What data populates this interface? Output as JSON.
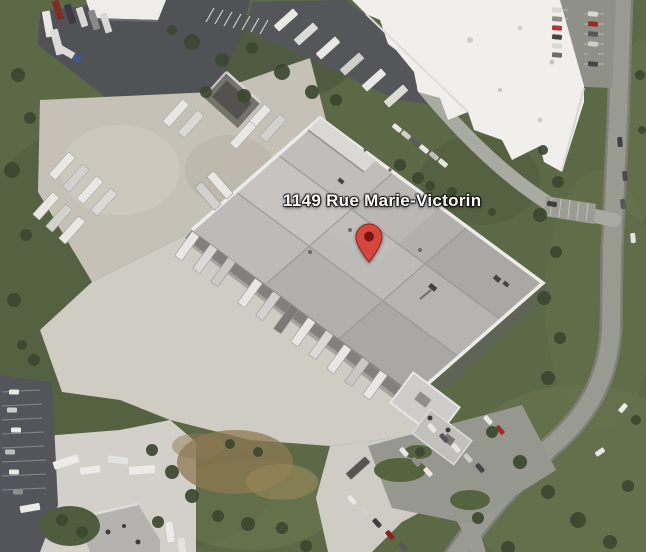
{
  "map": {
    "view_type": "satellite",
    "address_label": "1149 Rue Marie-Victorin",
    "marker": {
      "kind": "red-pin",
      "body_color": "#d7463c",
      "outline_color": "#8e241c",
      "dot_color": "#77150e"
    },
    "label_style": {
      "text_color": "#ffffff",
      "halo_color": "#000000"
    }
  },
  "palette": {
    "vegetation": "#5c6947",
    "trees": "#3b4830",
    "warehouse_roof": "#b2b0ac",
    "white_roof": "#f0efec",
    "asphalt": "#515256",
    "gravel": "#c6c1b6",
    "concrete": "#cfccc4",
    "road": "#999b92",
    "dirt": "#8d7a52"
  }
}
